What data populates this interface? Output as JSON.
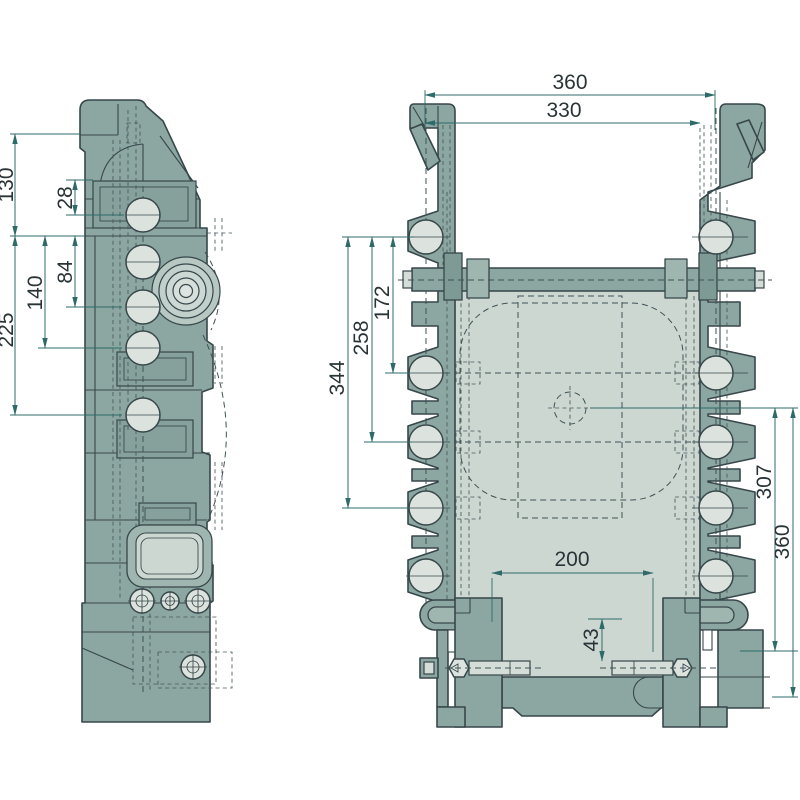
{
  "drawing": {
    "type": "technical_drawing",
    "background": "#ffffff",
    "colors": {
      "body_fill": "#8CA7A1",
      "body_fill_light": "#9FB5AF",
      "body_fill_dark": "#7E9A95",
      "interior_panel_fill": "#CDD7D2",
      "hole_fill": "#DCE2DD",
      "outline": "#37474A",
      "dimension_line": "#2E6B68",
      "dimension_text": "#2A3437"
    },
    "views": {
      "side_view": {
        "dimensions": [
          {
            "id": "dim-130",
            "label": "130"
          },
          {
            "id": "dim-28",
            "label": "28"
          },
          {
            "id": "dim-84",
            "label": "84"
          },
          {
            "id": "dim-140",
            "label": "140"
          },
          {
            "id": "dim-225",
            "label": "225"
          }
        ]
      },
      "front_view": {
        "dimensions": [
          {
            "id": "dim-360-top",
            "label": "360"
          },
          {
            "id": "dim-330",
            "label": "330"
          },
          {
            "id": "dim-172",
            "label": "172"
          },
          {
            "id": "dim-258",
            "label": "258"
          },
          {
            "id": "dim-344",
            "label": "344"
          },
          {
            "id": "dim-307",
            "label": "307"
          },
          {
            "id": "dim-360-right",
            "label": "360"
          },
          {
            "id": "dim-200",
            "label": "200"
          },
          {
            "id": "dim-43",
            "label": "43"
          }
        ]
      }
    }
  }
}
